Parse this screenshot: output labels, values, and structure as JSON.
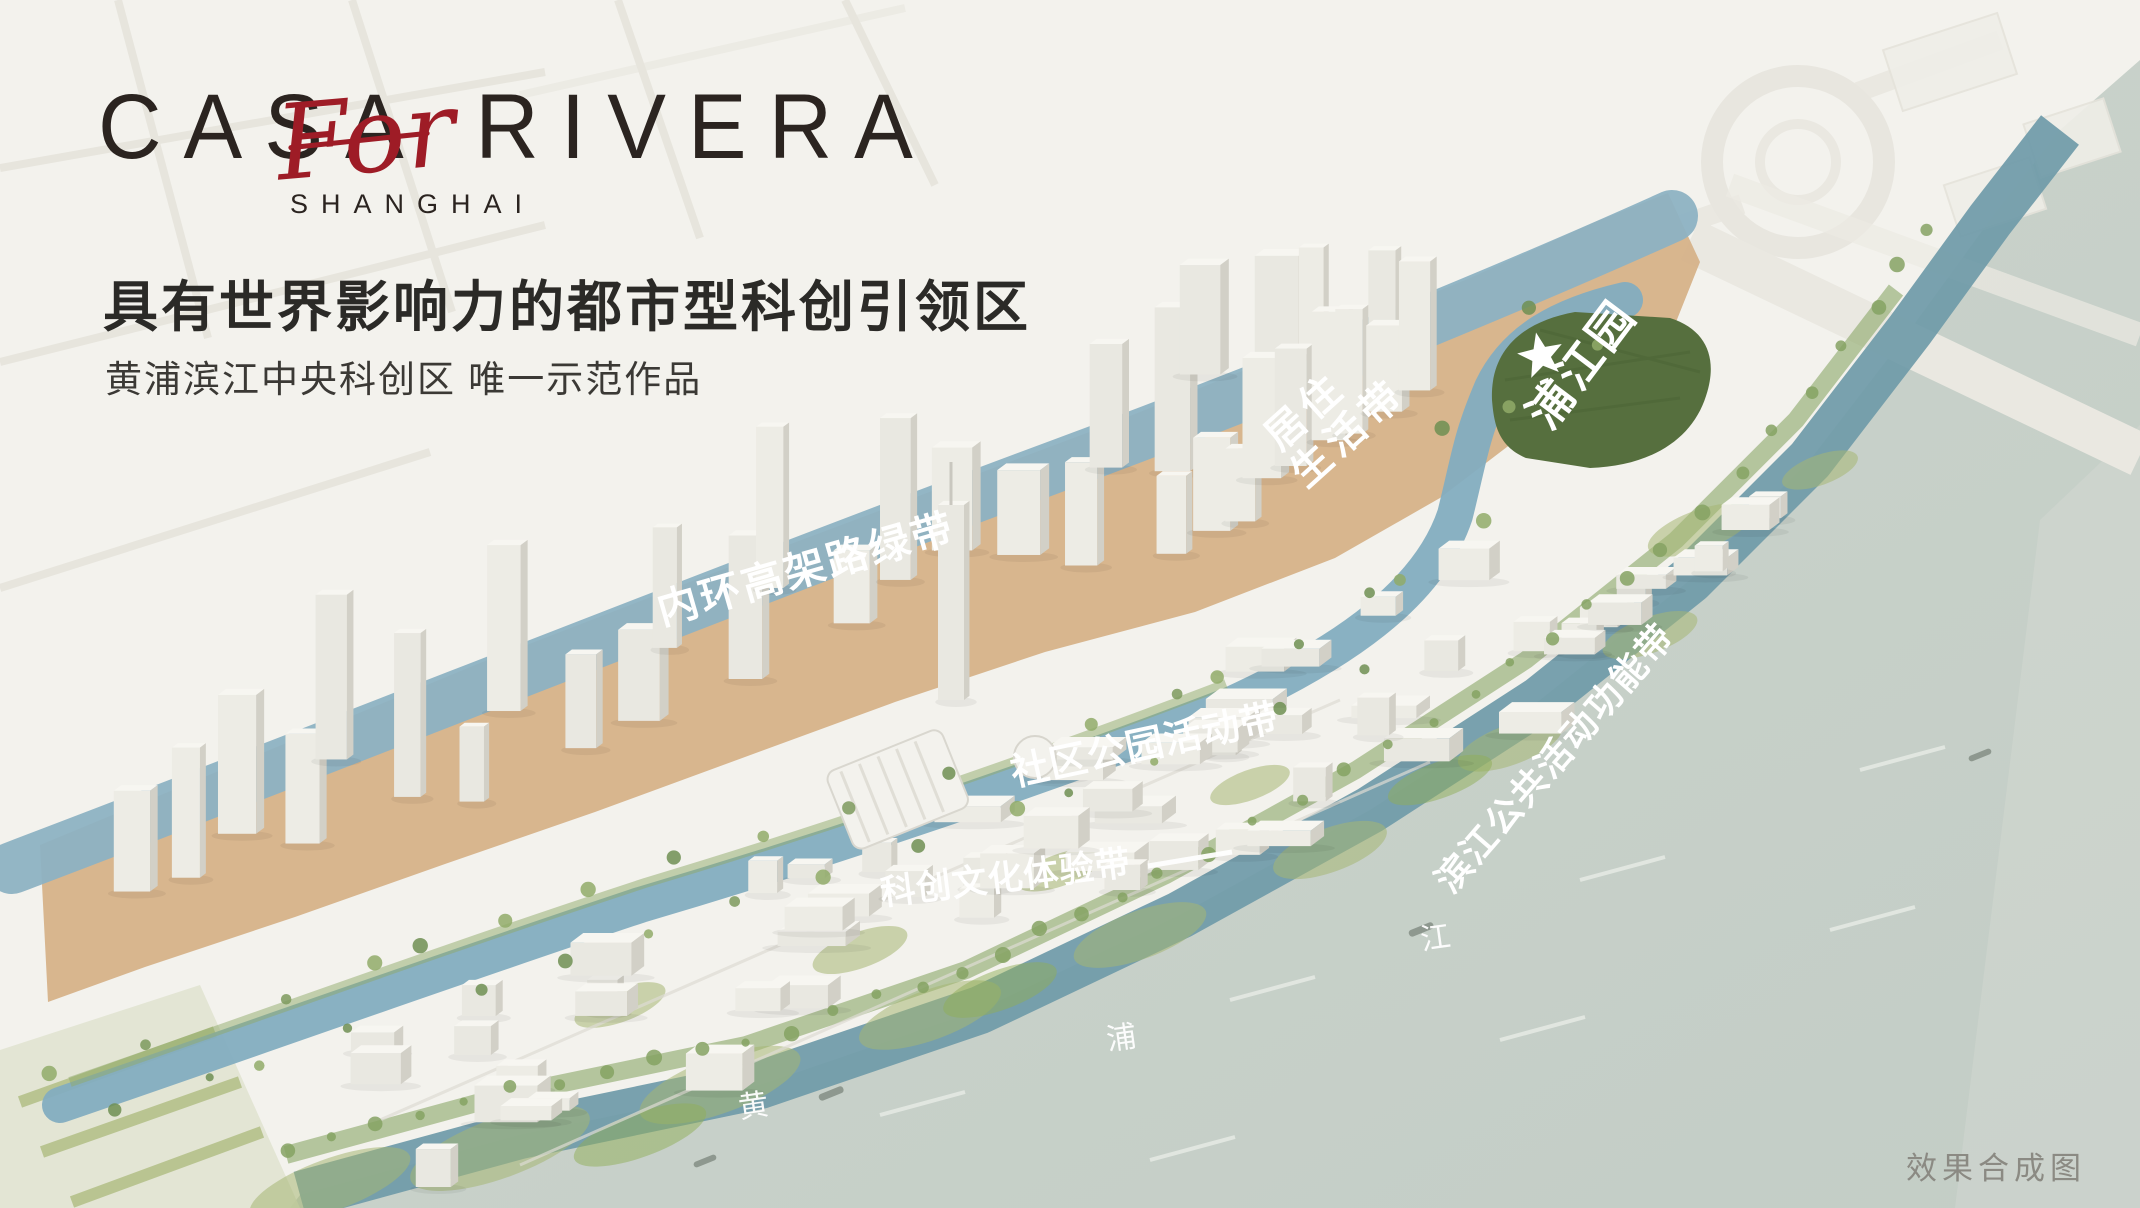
{
  "branding": {
    "logo_main": "CASA RIVERA",
    "logo_script": "For",
    "logo_sub": "SHANGHAI"
  },
  "header": {
    "headline": "具有世界影响力的都市型科创引领区",
    "subheadline": "黄浦滨江中央科创区 唯一示范作品"
  },
  "map": {
    "labels": {
      "inner_ring_green_belt": "内环高架路绿带",
      "residential_living_belt_line1": "居住",
      "residential_living_belt_line2": "生活带",
      "pujiang_park": "浦江园",
      "community_park_activity_belt": "社区公园活动带",
      "riverside_public_activity_belt": "滨江公共活动功能带",
      "tech_culture_experience_belt": "科创文化体验带",
      "river_name_char_1": "黄",
      "river_name_char_2": "浦",
      "river_name_char_3": "江"
    },
    "caption": "效果合成图"
  },
  "colors": {
    "accent_red": "#9e1c26",
    "ink": "#2b2420",
    "headline_ink": "#2b2a27",
    "tan_band": "#d6b289",
    "elevated_green_belt_blue": "#8db2c3",
    "canal_blue": "#83adc0",
    "shore_band_teal": "#6f9aa8",
    "river_grey_green": "#c9d2cb",
    "park_green": "#566f3e",
    "label_white": "#ffffff",
    "caption_grey": "#8b8a83"
  }
}
